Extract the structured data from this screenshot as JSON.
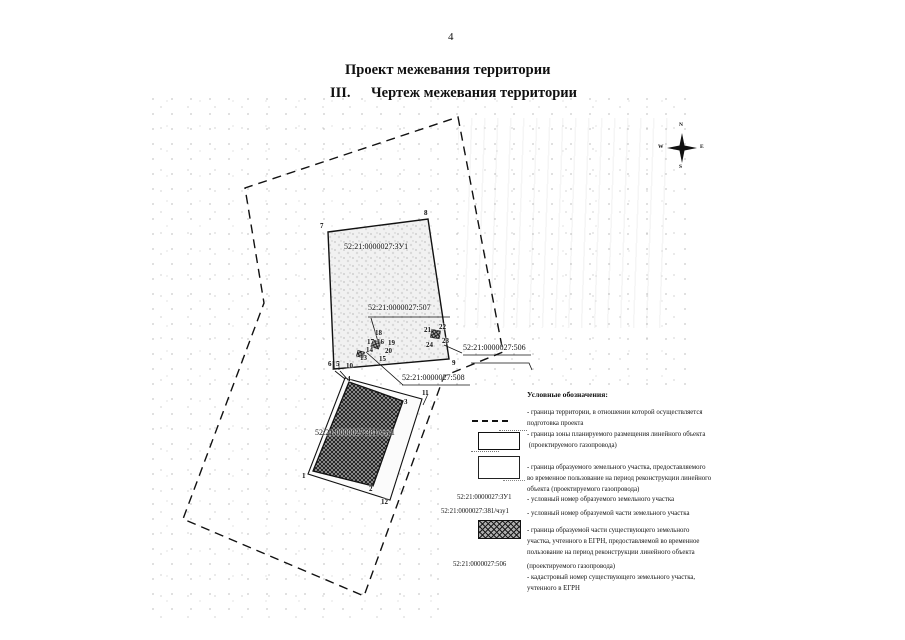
{
  "page": {
    "number": "4"
  },
  "title": {
    "line1": "Проект межевания территории",
    "numeral": "III.",
    "line2": "Чертеж межевания территории"
  },
  "compass": {
    "north": "N",
    "south": "S",
    "west": "W",
    "east": "E"
  },
  "map": {
    "labels": [
      {
        "text": "52:21:0000027:ЗУ1",
        "x": 344,
        "y": 243
      },
      {
        "text": "52:21:0000027:507",
        "x": 368,
        "y": 304
      },
      {
        "text": "52:21:0000027:508",
        "x": 402,
        "y": 374
      },
      {
        "text": "52:21:0000027:506",
        "x": 463,
        "y": 344
      },
      {
        "text": "52:21:0000027:381/чзу1",
        "x": 315,
        "y": 429
      }
    ],
    "points": [
      {
        "n": "1",
        "x": 302,
        "y": 473
      },
      {
        "n": "2",
        "x": 369,
        "y": 486
      },
      {
        "n": "3",
        "x": 404,
        "y": 399
      },
      {
        "n": "4",
        "x": 347,
        "y": 376
      },
      {
        "n": "5",
        "x": 336,
        "y": 361
      },
      {
        "n": "6",
        "x": 328,
        "y": 361
      },
      {
        "n": "7",
        "x": 320,
        "y": 223
      },
      {
        "n": "8",
        "x": 424,
        "y": 210
      },
      {
        "n": "9",
        "x": 452,
        "y": 360
      },
      {
        "n": "10",
        "x": 346,
        "y": 363
      },
      {
        "n": "11",
        "x": 422,
        "y": 390
      },
      {
        "n": "12",
        "x": 381,
        "y": 499
      },
      {
        "n": "13",
        "x": 360,
        "y": 355
      },
      {
        "n": "14",
        "x": 366,
        "y": 347
      },
      {
        "n": "15",
        "x": 379,
        "y": 356
      },
      {
        "n": "16",
        "x": 377,
        "y": 339
      },
      {
        "n": "17",
        "x": 367,
        "y": 339
      },
      {
        "n": "18",
        "x": 375,
        "y": 330
      },
      {
        "n": "19",
        "x": 388,
        "y": 340
      },
      {
        "n": "20",
        "x": 385,
        "y": 348
      },
      {
        "n": "21",
        "x": 424,
        "y": 327
      },
      {
        "n": "22",
        "x": 439,
        "y": 324
      },
      {
        "n": "23",
        "x": 442,
        "y": 338
      },
      {
        "n": "24",
        "x": 426,
        "y": 342
      }
    ]
  },
  "legend": {
    "header": "Условные обозначения:",
    "items": [
      {
        "text": "- граница территории, в отношении которой осуществляется\nподготовка проекта"
      },
      {
        "text": "- граница зоны планируемого размещения линейного объекта\n (проектируемого газопровода)"
      },
      {
        "text": "- граница образуемого земельного участка, предоставляемого\nво временное пользование на период реконструкции линейного\nобъекта (проектируемого газопровода)"
      },
      {
        "label": "52:21:0000027:ЗУ1",
        "text": "- условный номер образуемого земельного участка"
      },
      {
        "label": "52:21:0000027:381/чзу1",
        "text": "- условный номер образуемой части земельного участка"
      },
      {
        "text": "- граница образуемой части существующего земельного\nучастка, учтенного в ЕГРН, предоставляемой во временное\nпользование на период реконструкции линейного объекта"
      },
      {
        "label": "52:21:0000027:506",
        "text": "(проектируемого газопровода)\n- кадастровый номер существующего земельного участка,\nучтенного в ЕГРН"
      }
    ]
  }
}
